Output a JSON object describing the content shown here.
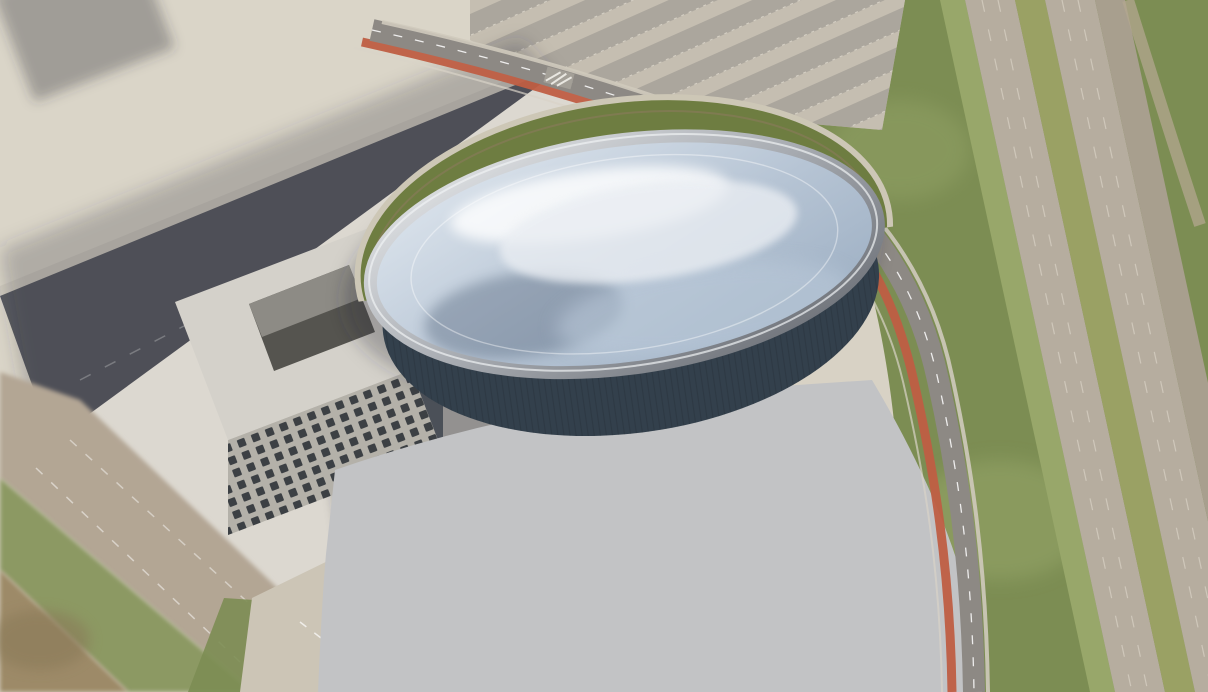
{
  "scene": {
    "title": "Aerial architectural rendering of an elliptical glass-roofed arena with surrounding plaza, parking lot, ring road and highway"
  },
  "colors": {
    "ground_light": "#d8d2c5",
    "ground_top": "#dad5c8",
    "park_green": "#7c8d53",
    "grass_light": "#98a76a",
    "highway_asphalt": "#b6ad9f",
    "median_green": "#9aa164",
    "shoulder": "#a89f8e",
    "dirt_path": "#b3a78f",
    "north_lot": "#beb7ab",
    "row_dark": "#a8a39a",
    "row_light": "#c6bfb2",
    "road_dark": "#57595f",
    "sidewalk": "#cfcabd",
    "sidewalk2": "#d0cbbf",
    "plaza": "#dcd8d0",
    "beige_road": "#b3a694",
    "grass_strip": "#8c9963",
    "dirt": "#9d8a68",
    "gravel": "#ccc5b6",
    "office_roof": "#d4d1ca",
    "office_front": "#b4b1a9",
    "office_side": "#4b5058",
    "courtyard": "#55544f",
    "courtyard_lit": "#8d8b85",
    "window": "#3c4044",
    "parking": "#c2c3c5",
    "island": "#79a43f",
    "ringroad": "#8d8984",
    "bike_lane": "#bf5e43",
    "curb": "#d8d3c8",
    "drive": "#b1ada5",
    "crescent": "#6e7d41",
    "crescent_edge": "#cdc7b6",
    "facade_dark": "#33404c",
    "facade_mid": "#3c5568",
    "facade_light": "#7e98a9",
    "facade_teal": "#9db6c6",
    "canopy": "#242b33",
    "dome1": "#e3eaf1",
    "dome2": "#b6c4d4",
    "dome3": "#97aabf",
    "rim1": "#e9ebed",
    "rim2": "#a7abb1",
    "rim3": "#62666d",
    "rib": "#f4f7fa",
    "bowl": "#7f8fa2",
    "roof_white": "#e9edf2",
    "bldg_roof": "#ebe9e4",
    "bldg_front": "#b3b2b0",
    "bldg_side": "#8d8d90",
    "tree_dark": "#4e6a2f",
    "tree_green": "#6d9140",
    "tree_light": "#8fb55a",
    "cloud": "#ffffff",
    "sky": "#2b4a66",
    "kiosk": "#2a5fc4",
    "person": "#24272b"
  },
  "district": {
    "buildings": [
      [
        20,
        -40,
        150,
        115,
        38
      ],
      [
        208,
        -52,
        118,
        128,
        44
      ],
      [
        362,
        -10,
        118,
        132,
        40
      ],
      [
        118,
        96,
        205,
        96,
        32
      ],
      [
        348,
        150,
        130,
        84,
        30
      ],
      [
        -52,
        80,
        112,
        86,
        28
      ],
      [
        -40,
        205,
        122,
        80,
        26
      ],
      [
        -14,
        458,
        106,
        74,
        22
      ]
    ]
  },
  "plaza": {
    "people": [
      [
        320,
        258
      ],
      [
        330,
        262
      ],
      [
        352,
        270
      ],
      [
        300,
        295
      ],
      [
        312,
        300
      ],
      [
        336,
        306
      ],
      [
        362,
        312
      ],
      [
        286,
        330
      ],
      [
        296,
        336
      ],
      [
        318,
        342
      ],
      [
        346,
        350
      ],
      [
        374,
        358
      ],
      [
        262,
        365
      ],
      [
        274,
        372
      ],
      [
        302,
        380
      ],
      [
        332,
        390
      ],
      [
        412,
        330
      ],
      [
        422,
        338
      ],
      [
        442,
        300
      ],
      [
        456,
        280
      ],
      [
        432,
        430
      ],
      [
        446,
        440
      ],
      [
        472,
        452
      ],
      [
        502,
        470
      ],
      [
        398,
        470
      ],
      [
        372,
        240
      ]
    ],
    "trees": [
      [
        640,
        172,
        6
      ],
      [
        602,
        196,
        6
      ],
      [
        566,
        220,
        6
      ],
      [
        530,
        244,
        6
      ],
      [
        494,
        266,
        6
      ],
      [
        458,
        289,
        6
      ],
      [
        424,
        310,
        5
      ],
      [
        390,
        332,
        5
      ],
      [
        352,
        302,
        5
      ],
      [
        330,
        254,
        5
      ],
      [
        362,
        478,
        6
      ],
      [
        340,
        452,
        6
      ]
    ],
    "kiosks": [
      [
        283,
        364
      ],
      [
        296,
        372
      ]
    ]
  },
  "arcs": [
    {
      "g": "plaza-steps",
      "cx": 628,
      "cy": 300,
      "ky": 0.85,
      "radii": [
        270,
        286,
        302,
        320,
        338,
        358,
        380,
        404,
        430
      ],
      "a1": 140,
      "a2": 228,
      "stroke": "rgba(255,255,255,0.5)",
      "w": 1.6
    },
    {
      "g": "plaza-steps",
      "cx": 628,
      "cy": 300,
      "ky": 0.85,
      "radii": [
        235,
        252
      ],
      "a1": 118,
      "a2": 162,
      "stroke": "rgba(255,255,255,0.45)",
      "w": 1.5
    },
    {
      "g": "plaza-steps",
      "cx": 628,
      "cy": 300,
      "ky": 0.85,
      "radii": [
        458,
        486
      ],
      "a1": 150,
      "a2": 210,
      "stroke": "rgba(255,255,255,0.3)",
      "w": 1.4
    },
    {
      "g": "stall-arcs",
      "cx": 628,
      "cy": 310,
      "ky": 0.82,
      "radii": [
        175,
        215,
        258,
        300,
        345,
        392,
        440,
        488
      ],
      "a1": 35,
      "a2": 145,
      "stroke": "rgba(255,255,255,0.6)",
      "w": 1.4,
      "dash": "2.5 8"
    },
    {
      "g": "stall-arcs",
      "cx": 628,
      "cy": 310,
      "ky": 0.82,
      "radii": [
        196,
        237,
        280,
        323,
        369,
        416,
        464
      ],
      "a1": 35,
      "a2": 145,
      "stroke": "rgba(255,255,255,0.3)",
      "w": 1
    },
    {
      "g": "drive-arcs",
      "cx": 628,
      "cy": 306,
      "ky": 0.5435,
      "radii": [
        276
      ],
      "a1": 28,
      "a2": 152,
      "stroke": "#b1ada5",
      "w": 19
    },
    {
      "g": "drive-arcs",
      "cx": 628,
      "cy": 306,
      "ky": 0.5435,
      "radii": [
        276
      ],
      "a1": 30,
      "a2": 150,
      "stroke": "rgba(255,255,255,0.55)",
      "w": 1.2,
      "dash": "8 11"
    },
    {
      "g": "drive-arcs",
      "cx": 628,
      "cy": 306,
      "ky": 0.53,
      "radii": [
        258
      ],
      "a1": 35,
      "a2": 145,
      "stroke": "#d6d2c9",
      "w": 2,
      "op": 0.8
    }
  ],
  "arena": {
    "bands": [
      {
        "cy": 300,
        "rx": 248,
        "ry": 130,
        "a1": 44,
        "a2": 138,
        "stroke": "#3c5568",
        "w": 13
      },
      {
        "cy": 294,
        "rx": 246,
        "ry": 128,
        "a1": 38,
        "a2": 142,
        "stroke": "#7e98a9",
        "w": 9,
        "op": 0.9
      },
      {
        "cy": 290,
        "rx": 240,
        "ry": 124,
        "a1": 60,
        "a2": 120,
        "stroke": "#9db6c6",
        "w": 5,
        "op": 0.7
      },
      {
        "cy": 302,
        "rx": 249,
        "ry": 132,
        "a1": 48,
        "a2": 134,
        "stroke": "#242b33",
        "w": 5,
        "dash": "1.5 10.5"
      }
    ],
    "ribs": {
      "count": 21,
      "top": 146,
      "spacing": 10.8,
      "x1": 372,
      "x2": 884
    },
    "bowl": {
      "cx": 590,
      "cy": 268,
      "r0": 40,
      "step": 13,
      "n": 8,
      "ky": 0.45
    },
    "crescent_bushes": [
      [
        470,
        118
      ],
      [
        510,
        106
      ],
      [
        560,
        98
      ],
      [
        612,
        94
      ],
      [
        664,
        94
      ],
      [
        714,
        99
      ],
      [
        762,
        108
      ],
      [
        800,
        120
      ]
    ]
  },
  "parking": {
    "cars": [
      [
        477,
        452,
        "r",
        "#23262b"
      ],
      [
        532,
        467,
        "r",
        "#1f2226"
      ],
      [
        492,
        507,
        "r",
        "#6b6f75"
      ],
      [
        422,
        478,
        "r",
        "#2b3e57"
      ],
      [
        398,
        530,
        "r",
        "#2f5577"
      ],
      [
        465,
        558,
        "r",
        "#34608a"
      ],
      [
        570,
        562,
        "t",
        "#e6e7e8"
      ],
      [
        687,
        525,
        "r",
        "#dfe1e3"
      ],
      [
        722,
        573,
        "r",
        "#9fa3a7"
      ],
      [
        553,
        612,
        "r",
        "#23262b"
      ],
      [
        695,
        618,
        "r",
        "#1f2226"
      ],
      [
        707,
        463,
        "r",
        "#23262b"
      ],
      [
        752,
        568,
        "t",
        "#8a8e93"
      ],
      [
        585,
        563,
        "t",
        "#d9dadc"
      ]
    ],
    "islands": [
      [
        598,
        470
      ],
      [
        600,
        523
      ],
      [
        637,
        527
      ],
      [
        607,
        587
      ],
      [
        647,
        582
      ],
      [
        618,
        622
      ],
      [
        658,
        624
      ],
      [
        452,
        625
      ],
      [
        765,
        607
      ],
      [
        788,
        548
      ],
      [
        695,
        480
      ]
    ],
    "drop_cars": [
      [
        500,
        438
      ],
      [
        560,
        452
      ],
      [
        740,
        438
      ],
      [
        835,
        400
      ]
    ]
  },
  "ring_road": {
    "cars": [
      [
        612,
        102,
        22
      ],
      [
        674,
        130,
        25
      ]
    ],
    "trees": [
      [
        586,
        96
      ],
      [
        644,
        116
      ],
      [
        702,
        142
      ],
      [
        756,
        172
      ],
      [
        806,
        210
      ],
      [
        846,
        254
      ],
      [
        876,
        302
      ],
      [
        898,
        352
      ],
      [
        916,
        404
      ],
      [
        930,
        458
      ],
      [
        940,
        514
      ],
      [
        948,
        572
      ],
      [
        954,
        630
      ],
      [
        958,
        686
      ]
    ]
  },
  "highway": {
    "cars": [
      [
        1018,
        172
      ],
      [
        1080,
        170
      ],
      [
        1032,
        256
      ],
      [
        1060,
        272
      ],
      [
        1090,
        288
      ],
      [
        1150,
        276
      ],
      [
        1120,
        330
      ],
      [
        1168,
        368
      ],
      [
        1138,
        374
      ],
      [
        1098,
        420
      ],
      [
        1146,
        470
      ],
      [
        1172,
        522
      ],
      [
        1005,
        128
      ],
      [
        965,
        60
      ]
    ]
  },
  "north_lot": {
    "cars": [
      [
        512,
        8
      ],
      [
        534,
        14
      ],
      [
        556,
        20
      ],
      [
        578,
        27
      ],
      [
        600,
        33
      ],
      [
        545,
        4
      ],
      [
        567,
        10
      ],
      [
        589,
        16
      ],
      [
        611,
        22
      ],
      [
        633,
        29
      ],
      [
        520,
        36
      ],
      [
        542,
        42
      ],
      [
        624,
        8
      ],
      [
        646,
        14
      ]
    ]
  },
  "park": {
    "trees": [
      [
        900,
        40,
        20
      ],
      [
        938,
        18,
        16
      ],
      [
        876,
        96,
        18
      ],
      [
        916,
        142,
        20
      ],
      [
        952,
        188,
        18
      ],
      [
        898,
        212,
        16
      ],
      [
        940,
        256,
        20
      ],
      [
        972,
        300,
        18
      ],
      [
        996,
        346,
        17
      ],
      [
        1006,
        402,
        18
      ],
      [
        1032,
        452,
        19
      ],
      [
        1058,
        504,
        20
      ],
      [
        1088,
        558,
        20
      ],
      [
        1104,
        614,
        18
      ],
      [
        1128,
        660,
        20
      ],
      [
        962,
        652,
        18
      ],
      [
        928,
        600,
        16
      ],
      [
        1008,
        586,
        15
      ],
      [
        1148,
        128,
        16
      ],
      [
        1184,
        92,
        15
      ],
      [
        1200,
        170,
        14
      ],
      [
        1178,
        248,
        15
      ],
      [
        1130,
        28,
        15
      ],
      [
        1182,
        16,
        14
      ],
      [
        868,
        648,
        16
      ],
      [
        836,
        684,
        14
      ],
      [
        914,
        638,
        15
      ],
      [
        952,
        668,
        17
      ],
      [
        782,
        688,
        12
      ],
      [
        736,
        689,
        10
      ]
    ],
    "gravel_trees": [
      [
        207,
        613,
        8
      ],
      [
        236,
        640,
        8
      ],
      [
        266,
        660,
        8
      ],
      [
        298,
        678,
        8
      ]
    ]
  },
  "clouds": [
    [
      948,
      -10,
      90,
      38,
      0.97
    ],
    [
      1040,
      -5,
      95,
      35,
      0.97
    ],
    [
      1140,
      -8,
      95,
      40,
      0.97
    ],
    [
      1205,
      40,
      80,
      50,
      0.95
    ],
    [
      996,
      42,
      90,
      42,
      0.95
    ],
    [
      1098,
      36,
      88,
      40,
      0.95
    ],
    [
      1168,
      100,
      80,
      48,
      0.93
    ],
    [
      1042,
      104,
      86,
      40,
      0.9
    ],
    [
      968,
      142,
      72,
      34,
      0.85
    ],
    [
      1090,
      170,
      92,
      46,
      0.88
    ],
    [
      1155,
      240,
      82,
      40,
      0.85
    ],
    [
      1010,
      226,
      62,
      30,
      0.72
    ],
    [
      942,
      300,
      58,
      28,
      0.55
    ],
    [
      1194,
      332,
      48,
      26,
      0.5
    ],
    [
      688,
      142,
      52,
      16,
      0.3
    ],
    [
      1196,
      452,
      42,
      24,
      0.65
    ],
    [
      1206,
      520,
      36,
      20,
      0.5
    ],
    [
      1088,
      654,
      72,
      36,
      0.9
    ],
    [
      1168,
      622,
      62,
      32,
      0.85
    ],
    [
      1008,
      686,
      58,
      22,
      0.8
    ],
    [
      902,
      86,
      50,
      24,
      0.5
    ],
    [
      1000,
      120,
      150,
      80,
      0.45
    ]
  ],
  "sky_patches": [
    [
      1032,
      6,
      42,
      12
    ],
    [
      1146,
      4,
      36,
      10
    ],
    [
      962,
      2,
      30,
      9
    ]
  ]
}
